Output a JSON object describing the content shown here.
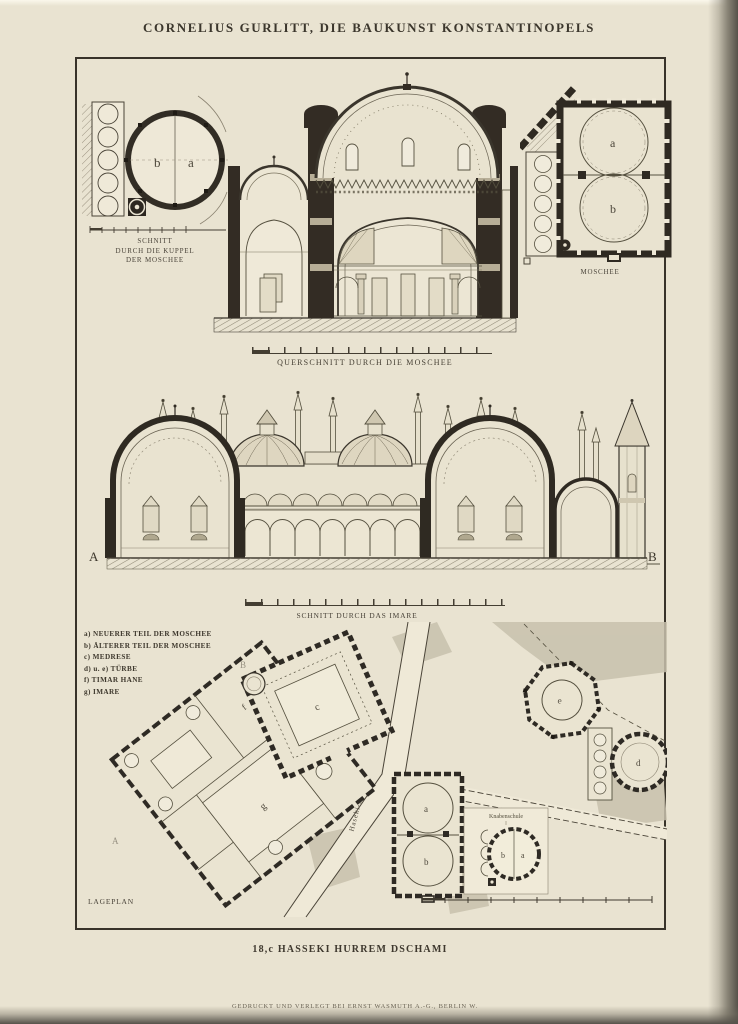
{
  "page": {
    "header_title": "CORNELIUS GURLITT, DIE BAUKUNST KONSTANTINOPELS",
    "plate_caption": "18,c HASSEKI HURREM DSCHAMI",
    "footer_imprint": "GEDRUCKT UND VERLEGT BEI ERNST WASMUTH A.-G., BERLIN W."
  },
  "figures": {
    "dome_plan": {
      "caption_line1": "SCHNITT",
      "caption_line2": "DURCH DIE KUPPEL",
      "caption_line3": "DER MOSCHEE",
      "label_left": "b",
      "label_right": "a"
    },
    "cross_section": {
      "caption": "QUERSCHNITT DURCH DIE MOSCHEE"
    },
    "mosque_plan": {
      "caption": "MOSCHEE",
      "label_upper": "a",
      "label_lower": "b"
    },
    "imaret_section": {
      "caption": "SCHNITT DURCH DAS IMARE",
      "marker_left": "A",
      "marker_right": "B"
    },
    "site_plan": {
      "caption": "LAGEPLAN",
      "street_label": "Haseki-Sokak",
      "school_label": "Knabenschule",
      "marker_a": "A",
      "marker_b": "B",
      "labels": {
        "mosque_new": "a",
        "mosque_old": "b",
        "medrese": "c",
        "tuerbe_d": "d",
        "tuerbe_e": "e",
        "timar_hane": "f",
        "imaret": "g",
        "inset_b": "b",
        "inset_a": "a"
      }
    }
  },
  "legend": {
    "items": [
      {
        "key": "a)",
        "text": "NEUERER TEIL DER MOSCHEE"
      },
      {
        "key": "b)",
        "text": "ÄLTERER TEIL DER MOSCHEE"
      },
      {
        "key": "c)",
        "text": "MEDRESE"
      },
      {
        "key": "d) u. e)",
        "text": "TÜRBE"
      },
      {
        "key": "f)",
        "text": "TIMAR HANE"
      },
      {
        "key": "g)",
        "text": "IMARE"
      }
    ]
  },
  "colors": {
    "paper": "#e9e3d1",
    "ink": "#3c372d",
    "dark_fill": "#2f2a22",
    "scan_edge": "#56524a"
  }
}
